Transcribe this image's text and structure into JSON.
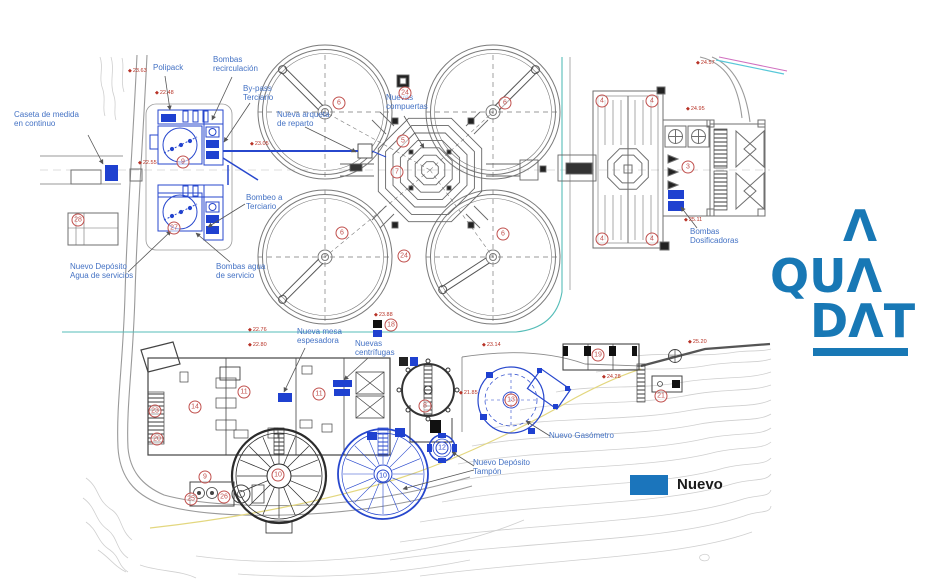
{
  "colors": {
    "label_blue": "#4472c4",
    "new_blue": "#2747cd",
    "new_fill": "#1f41d0",
    "legend_blue": "#1b75bc",
    "logo_blue": "#1878b5",
    "marker_red": "#b73226",
    "badge_red": "#c0504d",
    "teal": "#56bdb8",
    "yellow": "#e3d77f"
  },
  "legend": {
    "label": "Nuevo"
  },
  "logo": {
    "top": "Λ",
    "mid": "QUΛ",
    "bottom": "DΛT"
  },
  "labels": [
    {
      "id": "caseta",
      "text": "Caseta de medida\nen continuo",
      "x": 14,
      "y": 110
    },
    {
      "id": "polipack",
      "text": "Polipack",
      "x": 153,
      "y": 63
    },
    {
      "id": "bombas-recirculacion",
      "text": "Bombas\nrecirculación",
      "x": 213,
      "y": 55
    },
    {
      "id": "bypass-terciario",
      "text": "By-pass\nTerciario",
      "x": 243,
      "y": 84
    },
    {
      "id": "nueva-arqueta",
      "text": "Nueva arqueta\nde reparto",
      "x": 277,
      "y": 110
    },
    {
      "id": "nuevas-compuertas",
      "text": "Nuevas\ncompuertas",
      "x": 386,
      "y": 93
    },
    {
      "id": "bombeo-terciario",
      "text": "Bombeo a\nTerciario",
      "x": 246,
      "y": 193
    },
    {
      "id": "deposito-agua-servicios",
      "text": "Nuevo Depósito\nAgua de servicios",
      "x": 70,
      "y": 262
    },
    {
      "id": "bombas-agua-servicio",
      "text": "Bombas agua\nde servicio",
      "x": 216,
      "y": 262
    },
    {
      "id": "mesa-espesadora",
      "text": "Nueva mesa\nespesadora",
      "x": 297,
      "y": 327
    },
    {
      "id": "nuevas-centrifugas",
      "text": "Nuevas\ncentrífugas",
      "x": 355,
      "y": 339
    },
    {
      "id": "nuevo-gasometro",
      "text": "Nuevo Gasómetro",
      "x": 549,
      "y": 431
    },
    {
      "id": "deposito-tampon",
      "text": "Nuevo Depósito\nTampón",
      "x": 473,
      "y": 458
    },
    {
      "id": "bombas-dosificadoras",
      "text": "Bombas\nDosificadoras",
      "x": 690,
      "y": 227
    }
  ],
  "badges": [
    {
      "n": "28",
      "x": 78,
      "y": 220,
      "c": "r"
    },
    {
      "n": "9",
      "x": 183,
      "y": 162,
      "c": "r"
    },
    {
      "n": "27",
      "x": 174,
      "y": 228,
      "c": "r"
    },
    {
      "n": "6",
      "x": 339,
      "y": 103,
      "c": "r"
    },
    {
      "n": "6",
      "x": 505,
      "y": 103,
      "c": "r"
    },
    {
      "n": "6",
      "x": 342,
      "y": 233,
      "c": "r"
    },
    {
      "n": "6",
      "x": 503,
      "y": 234,
      "c": "r"
    },
    {
      "n": "24",
      "x": 405,
      "y": 93,
      "c": "r"
    },
    {
      "n": "24",
      "x": 404,
      "y": 256,
      "c": "r"
    },
    {
      "n": "5",
      "x": 403,
      "y": 141,
      "c": "r"
    },
    {
      "n": "7",
      "x": 397,
      "y": 172,
      "c": "r"
    },
    {
      "n": "4",
      "x": 602,
      "y": 101,
      "c": "r"
    },
    {
      "n": "4",
      "x": 652,
      "y": 101,
      "c": "r"
    },
    {
      "n": "4",
      "x": 602,
      "y": 239,
      "c": "r"
    },
    {
      "n": "4",
      "x": 652,
      "y": 239,
      "c": "r"
    },
    {
      "n": "3",
      "x": 688,
      "y": 167,
      "c": "r"
    },
    {
      "n": "18",
      "x": 391,
      "y": 325,
      "c": "r"
    },
    {
      "n": "23",
      "x": 155,
      "y": 411,
      "c": "r"
    },
    {
      "n": "14",
      "x": 195,
      "y": 407,
      "c": "r"
    },
    {
      "n": "20",
      "x": 157,
      "y": 439,
      "c": "r"
    },
    {
      "n": "11",
      "x": 244,
      "y": 392,
      "c": "r"
    },
    {
      "n": "11",
      "x": 319,
      "y": 394,
      "c": "r"
    },
    {
      "n": "8",
      "x": 425,
      "y": 406,
      "c": "r"
    },
    {
      "n": "12",
      "x": 442,
      "y": 448,
      "c": "b"
    },
    {
      "n": "10",
      "x": 278,
      "y": 475,
      "c": "r"
    },
    {
      "n": "10",
      "x": 383,
      "y": 476,
      "c": "b"
    },
    {
      "n": "9",
      "x": 205,
      "y": 477,
      "c": "r"
    },
    {
      "n": "25",
      "x": 191,
      "y": 499,
      "c": "r"
    },
    {
      "n": "26",
      "x": 224,
      "y": 497,
      "c": "r"
    },
    {
      "n": "19",
      "x": 598,
      "y": 355,
      "c": "r"
    },
    {
      "n": "21",
      "x": 661,
      "y": 396,
      "c": "r"
    },
    {
      "n": "13",
      "x": 511,
      "y": 400,
      "c": "r"
    }
  ],
  "elevations": [
    {
      "v": "23.63",
      "x": 128,
      "y": 68
    },
    {
      "v": "22.48",
      "x": 155,
      "y": 90
    },
    {
      "v": "22.55",
      "x": 138,
      "y": 160
    },
    {
      "v": "23.05",
      "x": 250,
      "y": 141
    },
    {
      "v": "23.88",
      "x": 374,
      "y": 312
    },
    {
      "v": "23.14",
      "x": 482,
      "y": 342
    },
    {
      "v": "24.57",
      "x": 696,
      "y": 60
    },
    {
      "v": "24.95",
      "x": 686,
      "y": 106
    },
    {
      "v": "25.11",
      "x": 684,
      "y": 217
    },
    {
      "v": "25.20",
      "x": 688,
      "y": 339
    },
    {
      "v": "24.28",
      "x": 602,
      "y": 374
    },
    {
      "v": "21.85",
      "x": 459,
      "y": 390
    },
    {
      "v": "22.76",
      "x": 248,
      "y": 327
    },
    {
      "v": "22.80",
      "x": 248,
      "y": 342
    }
  ]
}
